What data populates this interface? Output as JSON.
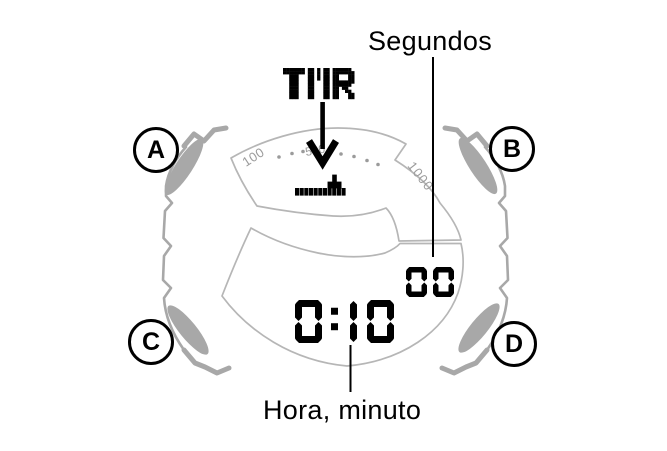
{
  "annotations": {
    "seconds_label": "Segundos",
    "hour_minute_label": "Hora, minuto"
  },
  "watch": {
    "buttons": [
      {
        "id": "a",
        "label": "A"
      },
      {
        "id": "b",
        "label": "B"
      },
      {
        "id": "c",
        "label": "C"
      },
      {
        "id": "d",
        "label": "D"
      }
    ],
    "display": {
      "mode_indicator": "TMR",
      "time": "0:10",
      "seconds": "00",
      "gauge": {
        "scale_labels": [
          "100",
          "500",
          "1000"
        ],
        "bar_segments": 11,
        "spike_segment": 9
      }
    }
  },
  "colors": {
    "case_gray": "#a8a8a8",
    "display_outline_gray": "#b6b6b6",
    "scale_text_gray": "#9b9b9b",
    "ink": "#000000"
  }
}
